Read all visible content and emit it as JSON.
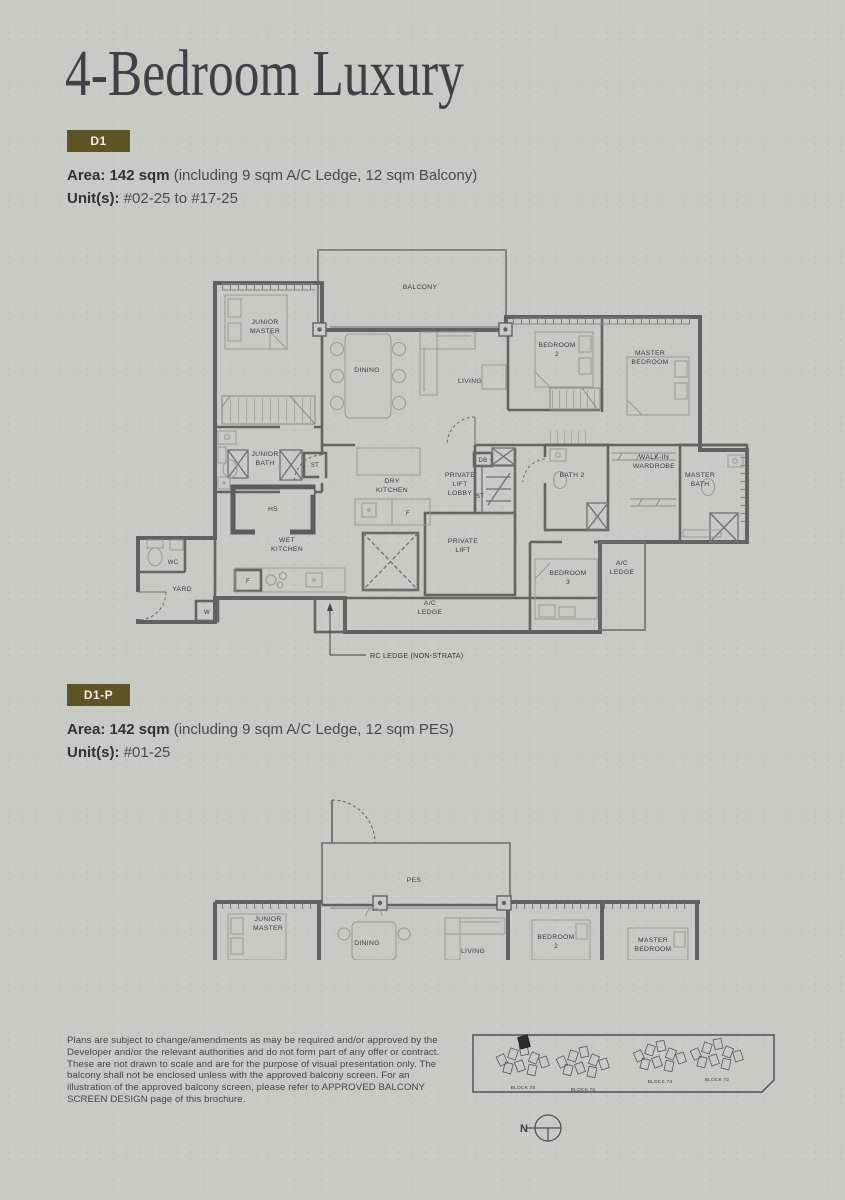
{
  "page": {
    "title": "4-Bedroom Luxury",
    "background": "#c8cac4",
    "accent": "#5d5426"
  },
  "sections": [
    {
      "badge": "D1",
      "area_bold": "Area: 142 sqm",
      "area_rest": "(including 9 sqm A/C Ledge, 12 sqm Balcony)",
      "units_bold": "Unit(s):",
      "units_rest": "#02-25 to #17-25"
    },
    {
      "badge": "D1-P",
      "area_bold": "Area: 142 sqm",
      "area_rest": "(including 9 sqm A/C Ledge, 12 sqm PES)",
      "units_bold": "Unit(s):",
      "units_rest": "#01-25"
    }
  ],
  "plan1": {
    "callout": "RC LEDGE (NON-STRATA)",
    "rooms": [
      {
        "x": 290,
        "y": 52,
        "lines": [
          "BALCONY"
        ]
      },
      {
        "x": 135,
        "y": 87,
        "lines": [
          "JUNIOR",
          "MASTER"
        ]
      },
      {
        "x": 237,
        "y": 135,
        "lines": [
          "DINING"
        ]
      },
      {
        "x": 340,
        "y": 146,
        "lines": [
          "LIVING"
        ]
      },
      {
        "x": 427,
        "y": 110,
        "lines": [
          "BEDROOM",
          "2"
        ]
      },
      {
        "x": 520,
        "y": 118,
        "lines": [
          "MASTER",
          "BEDROOM"
        ]
      },
      {
        "x": 135,
        "y": 219,
        "lines": [
          "JUNIOR",
          "BATH"
        ]
      },
      {
        "x": 185,
        "y": 230,
        "lines": [
          "ST"
        ],
        "small": true
      },
      {
        "x": 143,
        "y": 274,
        "lines": [
          "HS"
        ]
      },
      {
        "x": 262,
        "y": 246,
        "lines": [
          "DRY",
          "KITCHEN"
        ]
      },
      {
        "x": 330,
        "y": 240,
        "lines": [
          "PRIVATE",
          "LIFT",
          "LOBBY"
        ]
      },
      {
        "x": 353,
        "y": 225,
        "lines": [
          "DB"
        ],
        "small": true
      },
      {
        "x": 350,
        "y": 261,
        "lines": [
          "ST"
        ],
        "small": true
      },
      {
        "x": 442,
        "y": 240,
        "lines": [
          "BATH 2"
        ]
      },
      {
        "x": 524,
        "y": 222,
        "lines": [
          "WALK-IN",
          "WARDROBE"
        ]
      },
      {
        "x": 570,
        "y": 240,
        "lines": [
          "MASTER",
          "BATH"
        ]
      },
      {
        "x": 157,
        "y": 305,
        "lines": [
          "WET",
          "KITCHEN"
        ]
      },
      {
        "x": 43,
        "y": 327,
        "lines": [
          "WC"
        ],
        "small": true
      },
      {
        "x": 52,
        "y": 354,
        "lines": [
          "YARD"
        ]
      },
      {
        "x": 77,
        "y": 377,
        "lines": [
          "W"
        ],
        "small": true
      },
      {
        "x": 118,
        "y": 346,
        "lines": [
          "F"
        ],
        "small": true
      },
      {
        "x": 278,
        "y": 278,
        "lines": [
          "F"
        ],
        "small": true
      },
      {
        "x": 333,
        "y": 306,
        "lines": [
          "PRIVATE",
          "LIFT"
        ]
      },
      {
        "x": 438,
        "y": 338,
        "lines": [
          "BEDROOM",
          "3"
        ]
      },
      {
        "x": 492,
        "y": 328,
        "lines": [
          "A/C",
          "LEDGE"
        ]
      },
      {
        "x": 300,
        "y": 368,
        "lines": [
          "A/C",
          "LEDGE"
        ]
      }
    ]
  },
  "plan2": {
    "rooms": [
      {
        "x": 284,
        "y": 92,
        "lines": [
          "PES"
        ]
      },
      {
        "x": 138,
        "y": 131,
        "lines": [
          "JUNIOR",
          "MASTER"
        ]
      },
      {
        "x": 237,
        "y": 155,
        "lines": [
          "DINING"
        ]
      },
      {
        "x": 343,
        "y": 163,
        "lines": [
          "LIVING"
        ]
      },
      {
        "x": 426,
        "y": 149,
        "lines": [
          "BEDROOM",
          "2"
        ]
      },
      {
        "x": 523,
        "y": 152,
        "lines": [
          "MASTER",
          "BEDROOM"
        ]
      }
    ]
  },
  "disclaimer": "Plans are subject to change/amendments as may be required and/or approved by the Developer and/or the relevant authorities and do not form part of any offer or contract. These are not drawn to scale and are for the purpose of visual presentation only. The balcony shall not be enclosed unless with the approved balcony screen. For an illustration of the approved balcony screen, please refer to APPROVED BALCONY SCREEN DESIGN page of this brochure.",
  "siteplan": {
    "blocks": [
      {
        "name": "BLOCK 78",
        "cx": 53,
        "cy": 33,
        "label_y": 59,
        "highlight": true
      },
      {
        "name": "BLOCK 76",
        "cx": 113,
        "cy": 35,
        "label_y": 61,
        "highlight": false
      },
      {
        "name": "BLOCK 74",
        "cx": 190,
        "cy": 29,
        "label_y": 53,
        "highlight": false
      },
      {
        "name": "BLOCK 72",
        "cx": 247,
        "cy": 27,
        "label_y": 51,
        "highlight": false
      }
    ],
    "north_label": "N"
  }
}
